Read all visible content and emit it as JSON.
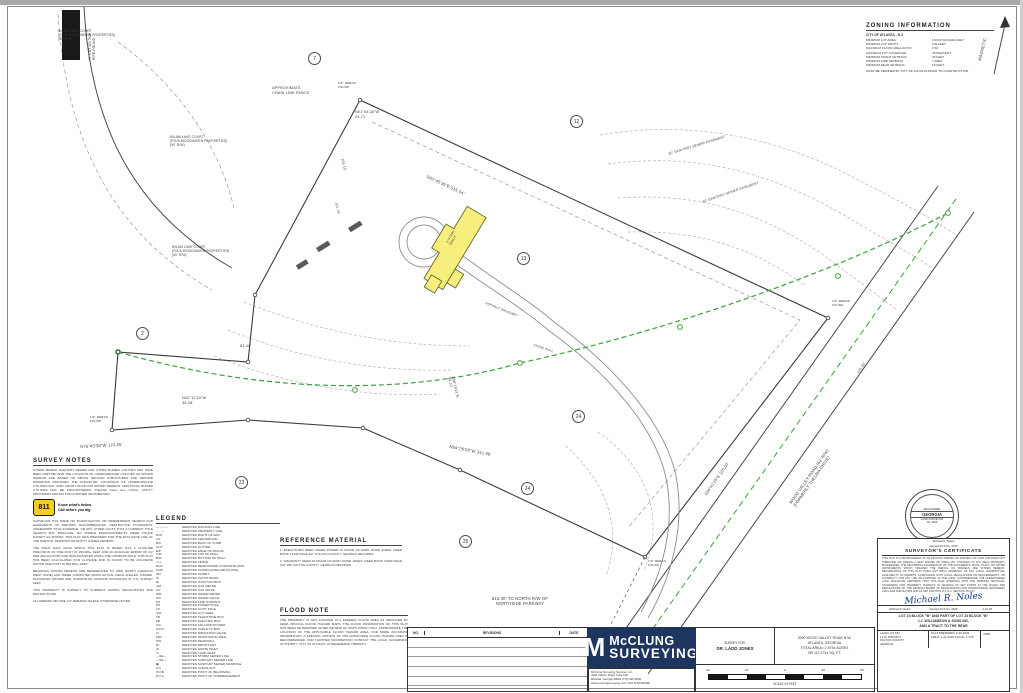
{
  "zoning": {
    "title": "ZONING INFORMATION",
    "jurisdiction": "CITY OF ATLANTA - R-3",
    "rows": [
      {
        "label": "MINIMUM LOT AREA:",
        "value": "18,000 SQUARE FEET"
      },
      {
        "label": "MINIMUM LOT WIDTH:",
        "value": "100 FEET"
      },
      {
        "label": "MAXIMUM FLOOR AREA RATIO:",
        "value": "0.50"
      },
      {
        "label": "MAXIMUM LOT COVERAGE:",
        "value": "35 PERCENT"
      },
      {
        "label": "MINIMUM FRONT SETBACK:",
        "value": "35 FEET"
      },
      {
        "label": "MINIMUM SIDE SETBACK:",
        "value": "7 FEET"
      },
      {
        "label": "MINIMUM REAR SETBACK:",
        "value": "15 FEET"
      }
    ],
    "footnote": "MUST BE VERIFIED BY CITY OF ATLANTA PRIOR TO CONSTRUCTION."
  },
  "notes": {
    "title": "SURVEY NOTES",
    "paras_top": [
      "STORM SEWER, SANITARY SEWER AND OTHER BURIED UTILITIES MAY HAVE BEEN OMITTED AND THE LOCATION OF UNDERGROUND UTILITIES AS SHOWN HEREON ARE BASED ON ABOVE GROUND STRUCTURES AND RECORD DRAWINGS PROVIDED THE SURVEYOR. LOCATIONS OF UNDERGROUND UTILITIES MAY VARY FROM LOCATIONS SHOWN HEREON. ADDITIONAL BURIED UTILITIES MAY BE ENCOUNTERED. PLEASE CALL ALL LOCAL UTILITY PROVIDERS AND 811 FOR FURTHER INFORMATION."
    ],
    "call811": {
      "number": "811",
      "line1": "Know what's below.",
      "line2": "Call before you dig."
    },
    "paras": [
      "SURVEYOR HAS MADE NO INVESTIGATION OR INDEPENDENT SEARCH FOR EASEMENTS OF RECORD, ENCUMBRANCES, RESTRICTIVE COVENANTS, OWNERSHIP TITLE EVIDENCE, OR ANY OTHER FACTS THAT A CURRENT TITLE SEARCH MAY DISCLOSE. NO VISIBLE ENCROACHMENTS WERE FOUND EXCEPT AS SHOWN. THIS PLAT WAS PREPARED FOR THE EXCLUSIVE USE OF THE PERSON, PERSONS OR ENTITY NAMED HEREON.",
      "THE FIELD DATA UPON WHICH THIS PLAT IS BASED HAS A CLOSURE PRECISION OF ONE FOOT IN 250,000+ FEET AND AN ANGULAR ERROR OF 01\" PER ANGLE POINT AND WAS ADJUSTED USING THE COMPASS RULE. THIS PLAT HAS BEEN CALCULATED FOR CLOSURE AND IS FOUND TO BE ACCURATE WITHIN ONE FOOT IN 500,000+ FEET.",
      "BEARINGS SHOWN HEREON ARE REFERENCED TO GRID NORTH (GEORGIA WEST ZONE) AND WERE COMPUTED FROM ACTUAL FIELD ANGLES TURNED. DISTANCES SHOWN ARE HORIZONTAL GROUND DISTANCES IN U.S. SURVEY FEET.",
      "THIS PROPERTY IS SUBJECT TO CURRENT ZONING REGULATIONS AND RESTRICTIONS.",
      "ALL REBARS SET ARE 1/2\" REBARS UNLESS OTHERWISE NOTED."
    ]
  },
  "legend": {
    "title": "LEGEND",
    "items": [
      {
        "s": "————",
        "d": "DENOTES BUILDING LINE"
      },
      {
        "s": "—··—",
        "d": "DENOTES PROPERTY LINE"
      },
      {
        "s": "R/W",
        "d": "DENOTES RIGHT-OF-WAY"
      },
      {
        "s": "C/L",
        "d": "DENOTES CENTERLINE"
      },
      {
        "s": "B/C",
        "d": "DENOTES BACK OF CURB"
      },
      {
        "s": "GUT",
        "d": "DENOTES GUTTER"
      },
      {
        "s": "E/P",
        "d": "DENOTES EDGE OF PAVING"
      },
      {
        "s": "T/W",
        "d": "DENOTES TOP OF WALL"
      },
      {
        "s": "B/W",
        "d": "DENOTES BOTTOM OF WALL"
      },
      {
        "s": "-x-x-",
        "d": "DENOTES FENCE"
      },
      {
        "s": "RCP",
        "d": "DENOTES REINFORCED CONCRETE PIPE"
      },
      {
        "s": "CMP",
        "d": "DENOTES CORRUGATED METAL PIPE"
      },
      {
        "s": "INV",
        "d": "DENOTES INVERT"
      },
      {
        "s": "⊡",
        "d": "DENOTES CATCH BASIN"
      },
      {
        "s": "⊞",
        "d": "DENOTES JUNCTION BOX"
      },
      {
        "s": "GM",
        "d": "DENOTES GAS METER"
      },
      {
        "s": "GV",
        "d": "DENOTES GAS VALVE"
      },
      {
        "s": "WM",
        "d": "DENOTES WATER METER"
      },
      {
        "s": "WV",
        "d": "DENOTES WATER VALVE"
      },
      {
        "s": "FH",
        "d": "DENOTES FIRE HYDRANT"
      },
      {
        "s": "PP",
        "d": "DENOTES POWER POLE"
      },
      {
        "s": "LP",
        "d": "DENOTES LIGHT POLE"
      },
      {
        "s": "GW",
        "d": "DENOTES GUY WIRE"
      },
      {
        "s": "TB",
        "d": "DENOTES TELEPHONE BOX"
      },
      {
        "s": "EB",
        "d": "DENOTES ELECTRIC BOX"
      },
      {
        "s": "A/C",
        "d": "DENOTES AIR CONDITIONER"
      },
      {
        "s": "CATV",
        "d": "DENOTES CABLE TV BOX"
      },
      {
        "s": "IV",
        "d": "DENOTES IRRIGATION VALVE"
      },
      {
        "s": "MW",
        "d": "DENOTES MONITORING WELL"
      },
      {
        "s": "HW",
        "d": "DENOTES HEADWALL"
      },
      {
        "s": "DI",
        "d": "DENOTES DROP INLET"
      },
      {
        "s": "GI",
        "d": "DENOTES GRATE INLET"
      },
      {
        "s": "YI",
        "d": "DENOTES YARD INLET"
      },
      {
        "s": "—SD—",
        "d": "DENOTES STORM SEWER LINE"
      },
      {
        "s": "—SS—",
        "d": "DENOTES SANITARY SEWER LINE"
      },
      {
        "s": "◉",
        "d": "DENOTES SANITARY SEWER MANHOLE"
      },
      {
        "s": "CO",
        "d": "DENOTES CLEAN OUT"
      },
      {
        "s": "P.O.B.",
        "d": "DENOTES POINT OF BEGINNING"
      },
      {
        "s": "P.O.C.",
        "d": "DENOTES POINT OF COMMENCEMENT"
      }
    ]
  },
  "reference": {
    "title": "REFERENCE MATERIAL",
    "items": [
      "1.  EXECUTOR'S DEED UNDER POWER IN FAVOR OF MARY ROSE JONES. DEED BOOK 13443 PAGE 297. FULTON COUNTY, GEORGIA RECORDS.",
      "2.  WARRANTY DEED IN FAVOR OF MARY ROSE JONES. DEED BOOK 14609 PAGE 107-109. FULTON COUNTY, GEORGIA RECORDS."
    ]
  },
  "flood": {
    "title": "FLOOD NOTE",
    "text": "THE PROPERTY IS NOT LOCATED IN A FEDERAL FLOOD AREA AS INDICATED BY FEMA OFFICIAL FLOOD HAZARD MAPS. THE FLOOD INFORMATION ON THIS PLAT HAS BEEN DETERMINED AFTER REVIEW OF MAPS WHICH ONLY APPROXIMATE THE LOCATION OF THE APPLICABLE FLOOD HAZARD AREA. FOR MORE ACCURATE INFORMATION, A SPECIFIC OPINION OF THE APPLICABLE FLOOD HAZARD AREA IS RECOMMENDED. FOR FURTHER INFORMATION CONTACT THE LOCAL GOVERNING AUTHORITY, CITY OF ATLANTA, IN REFERENCE THERETO."
  },
  "drawing": {
    "labels": [
      {
        "t": "'X' CUT ON TOP\nPIPE FOUND",
        "x": 88,
        "y": 60,
        "r": -90,
        "fs": 3.4
      },
      {
        "t": "MILAM LAKE COURT\n(F/K/A WOODHAVEN PROPERTIES)\n(50' R/W)",
        "x": 58,
        "y": 30,
        "fs": 3.2
      },
      {
        "t": "MILAM LAKE COURT\n(F/K/A WOODHAVEN PROPERTIES)\n(50' R/W)",
        "x": 170,
        "y": 136,
        "fs": 3.2
      },
      {
        "t": "MILAM LAKE COURT\n(F/K/A WOODHAVEN PROPERTIES)\n(50' R/W)",
        "x": 172,
        "y": 246,
        "fs": 3.2
      },
      {
        "t": "APPROXIMATE\nCHAIN LINK FENCE",
        "x": 272,
        "y": 86,
        "fs": 3.8
      },
      {
        "t": "N01°04'28\"W\n24.71'",
        "x": 355,
        "y": 110,
        "fs": 3.8
      },
      {
        "t": "S63°45'35\"E    515.04'",
        "x": 428,
        "y": 174,
        "r": 25,
        "fs": 4.2
      },
      {
        "t": "103.15'",
        "x": 344,
        "y": 158,
        "r": 76,
        "fs": 3.6
      },
      {
        "t": "101.19'",
        "x": 338,
        "y": 202,
        "r": 76,
        "fs": 3.4
      },
      {
        "t": "20' SANITARY SEWER EASEMENT",
        "x": 668,
        "y": 152,
        "r": -17,
        "fs": 3.4
      },
      {
        "t": "20' SANITARY SEWER EASEMENT",
        "x": 702,
        "y": 200,
        "r": -19,
        "fs": 3.4
      },
      {
        "t": "63.44'",
        "x": 240,
        "y": 344,
        "fs": 3.8
      },
      {
        "t": "N02°12'24\"W\n39.28'",
        "x": 182,
        "y": 396,
        "fs": 3.8
      },
      {
        "t": "N76°43'38\"W   110.45'",
        "x": 80,
        "y": 444,
        "r": -3,
        "fs": 4.2
      },
      {
        "t": "S36°14'21\"E\n56.10'",
        "x": 455,
        "y": 376,
        "r": 78,
        "fs": 3.6
      },
      {
        "t": "N54°26'05\"W   341.99'",
        "x": 450,
        "y": 444,
        "r": 11,
        "fs": 4.2
      },
      {
        "t": "S34°41'25\"E   125.00'",
        "x": 704,
        "y": 494,
        "r": -55,
        "fs": 4
      },
      {
        "t": "126.05'",
        "x": 856,
        "y": 372,
        "r": -55,
        "fs": 3.6
      },
      {
        "t": "WOOD VALLEY ROAD (60' R/W)\n(FORMERLY THELMA DRIVE)",
        "x": 788,
        "y": 502,
        "r": -55,
        "fs": 4.2
      },
      {
        "t": "616.30' TO NORTH R/W OF\nNORTHSIDE PARKWAY",
        "x": 470,
        "y": 596,
        "fs": 4.2,
        "w": 100,
        "ta": "center"
      },
      {
        "t": "MAGNETIC",
        "x": 977,
        "y": 60,
        "r": -76,
        "fs": 4.2
      },
      {
        "t": "ASPHALT DRIVEWAY",
        "x": 486,
        "y": 302,
        "r": 22,
        "fs": 3.2
      },
      {
        "t": "2 STORY\nBRICK",
        "x": 446,
        "y": 242,
        "r": -59,
        "fs": 3.2
      },
      {
        "t": "STONE WALL",
        "x": 534,
        "y": 344,
        "r": 18,
        "fs": 3
      },
      {
        "t": "1/2\" REBAR\nFOUND",
        "x": 338,
        "y": 82,
        "fs": 3
      },
      {
        "t": "1/2\" REBAR\nFOUND",
        "x": 832,
        "y": 300,
        "fs": 3
      },
      {
        "t": "1/2\" REBAR\nFOUND",
        "x": 648,
        "y": 560,
        "fs": 3
      },
      {
        "t": "1/2\" REBAR\nFOUND",
        "x": 90,
        "y": 416,
        "fs": 3
      }
    ],
    "lot_numbers": [
      {
        "n": "7",
        "x": 308,
        "y": 52
      },
      {
        "n": "12",
        "x": 570,
        "y": 115
      },
      {
        "n": "13",
        "x": 517,
        "y": 252
      },
      {
        "n": "2",
        "x": 136,
        "y": 327
      },
      {
        "n": "24",
        "x": 572,
        "y": 410
      },
      {
        "n": "24",
        "x": 521,
        "y": 482
      },
      {
        "n": "25",
        "x": 459,
        "y": 535
      },
      {
        "n": "23",
        "x": 235,
        "y": 476
      }
    ]
  },
  "titleblock": {
    "revisions": {
      "col_no": "NO.",
      "col_rev": "REVISIONS",
      "col_date": "DATE"
    },
    "logo": {
      "m": "M",
      "name1": "McCLUNG",
      "name2": "SURVEYING"
    },
    "firm_lines": [
      "McClung Surveying Services, Inc.",
      "4405 Canton Road, Suite 100",
      "Marietta, Georgia 30066   (770) 926-5000",
      "www.mcclungsurveying.com   COA #LSF000498"
    ],
    "survey_for_label": "SURVEY FOR:",
    "client": "DR. LADD JONES",
    "site": [
      "3200 WOOD VALLEY ROAD N.W.",
      "ATLANTA, GEORGIA",
      "TOTAL AREA= 2.575± ACRES",
      "OR 112,174± SQ. FT."
    ],
    "scale_ticks": [
      "30'",
      "15'",
      "0",
      "30'",
      "60'"
    ],
    "scale_caption": "SCALE IN FEET",
    "certificate": {
      "pre1": "Michael R. Noles",
      "pre2": "Georgia PLS No. 2646",
      "title": "SURVEYOR'S CERTIFICATE",
      "body": "THIS PLAT IS A RETRACEMENT OF AN EXISTING PARCEL OR PARCELS OF LAND AND DOES NOT SUBDIVIDE OR CREATE A NEW PARCEL OR MAKE ANY CHANGES TO ANY REAL PROPERTY BOUNDARIES. THE RECORDING INFORMATION OF THE DOCUMENTS, MAPS, PLATS, OR OTHER INSTRUMENTS WHICH CREATED THE PARCEL OR PARCELS ARE STATED HEREON. RECORDATION OF THIS PLAT DOES NOT IMPLY APPROVAL OF ANY LOCAL JURISDICTION, AVAILABILITY OF PERMITS, COMPLIANCE WITH LOCAL REGULATIONS OR REQUIREMENTS, OR SUITABILITY FOR ANY USE OR PURPOSE OF THE LAND. FURTHERMORE, THE UNDERSIGNED LAND SURVEYOR CERTIFIES THAT THIS PLAT COMPLIES WITH THE MINIMUM TECHNICAL STANDARDS FOR PROPERTY SURVEYS IN GEORGIA AS SET FORTH IN THE RULES AND REGULATIONS OF THE GEORGIA BOARD OF REGISTRATION FOR PROFESSIONAL ENGINEERS AND LAND SURVEYORS AND AS SET FORTH IN O.C.G.A. SECTION 15-6-67.",
      "signature": "Michael R. Noles",
      "sig_name": "Michael R. Noles",
      "sig_reg": "Georgia PLS No. 2646",
      "sig_date": "2-21-25"
    },
    "lot_lines": [
      "LOT 23 BLOCK \"B\" AND PART OF LOT 24 BLOCK \"B\"",
      "J.J. WILLIAMSON & SONS INC.",
      "AND A TRACT TO THE REAR"
    ],
    "location": [
      "LAND LOT 182",
      "17TH DISTRICT",
      "FULTON COUNTY",
      "GEORGIA"
    ],
    "dates": [
      "PLAT PREPARED: 2-25-2025",
      "FIELD: 2-21-2025    SCALE: 1\"=30'"
    ],
    "job_label": "JOB#",
    "seal": {
      "state": "GEORGIA",
      "line1": "REGISTERED",
      "line2": "LAND SURVEYOR",
      "number": "No. 2646"
    }
  }
}
